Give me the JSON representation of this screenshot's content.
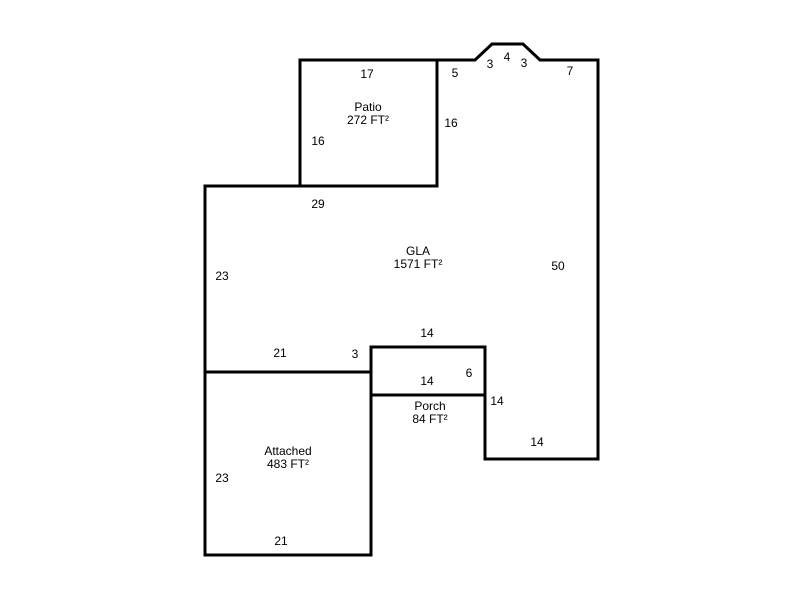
{
  "plan": {
    "background": "#ffffff",
    "line_color": "#000000",
    "areas": {
      "patio": {
        "label": "Patio",
        "area": "272 FT²"
      },
      "gla": {
        "label": "GLA",
        "area": "1571 FT²"
      },
      "porch": {
        "label": "Porch",
        "area": "84 FT²"
      },
      "attached": {
        "label": "Attached",
        "area": "483 FT²"
      }
    },
    "dims": {
      "patio_top": "17",
      "patio_left": "16",
      "gla_top_left_seg": "5",
      "bump_left": "3",
      "bump_top": "4",
      "bump_right": "3",
      "gla_top_right_seg": "7",
      "gla_side_at_patio": "16",
      "gla_top_width": "29",
      "gla_left_side": "23",
      "gla_right_side": "50",
      "porch_top": "14",
      "gla_bottom_left": "21",
      "gla_step": "3",
      "porch_width": "14",
      "porch_height": "6",
      "gla_notch_right": "14",
      "gla_bottom_right": "14",
      "attached_left": "23",
      "attached_bottom": "21"
    }
  }
}
